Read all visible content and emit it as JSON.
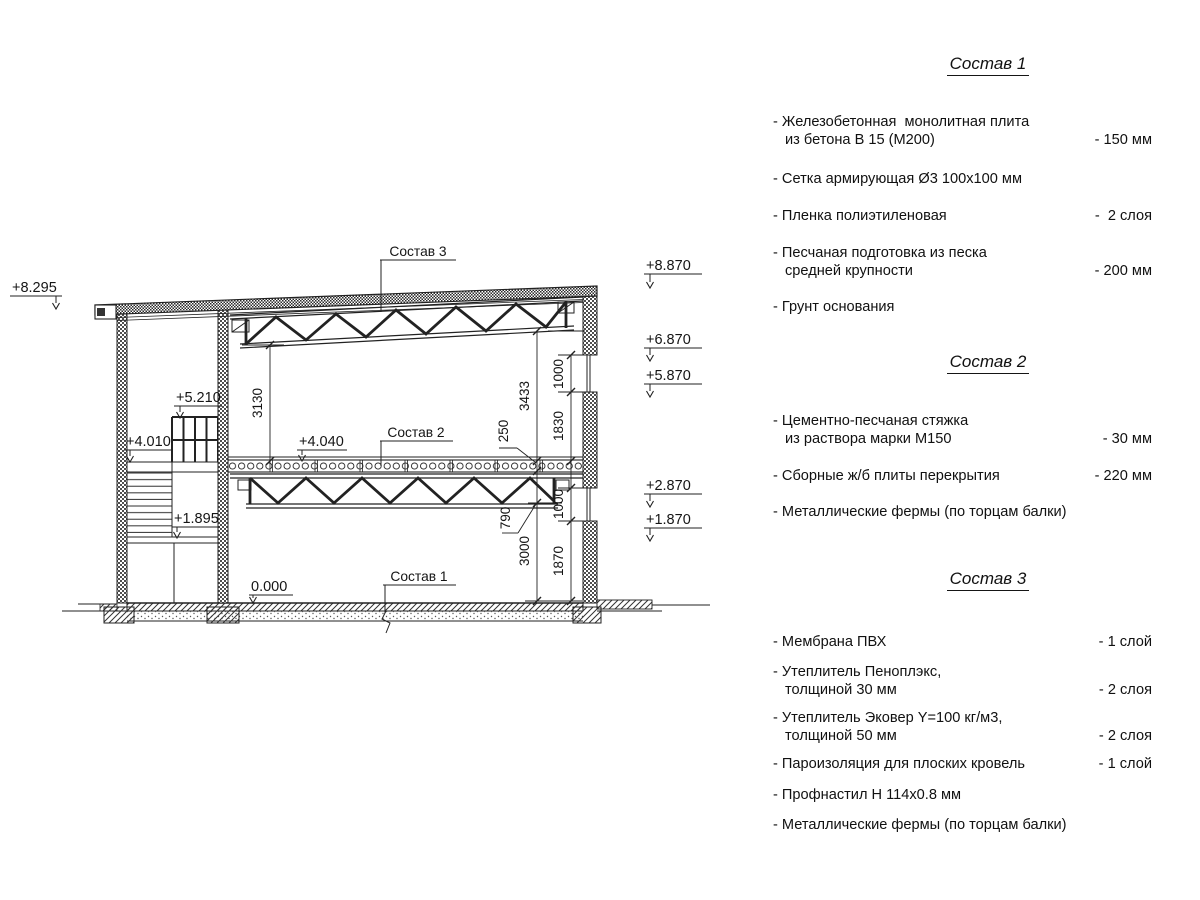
{
  "panel": {
    "sections": [
      {
        "title": "Состав 1",
        "items": [
          {
            "l1": "- Железобетонная  монолитная плита",
            "l2": "из бетона В 15 (М200)",
            "val": "- 150 мм"
          },
          {
            "l1": "- Сетка армирующая Ø3 100x100 мм",
            "l2": "",
            "val": ""
          },
          {
            "l1": "- Пленка полиэтиленовая",
            "l2": "",
            "val": "-  2 слоя"
          },
          {
            "l1": "- Песчаная подготовка из песка",
            "l2": "средней крупности",
            "val": "- 200 мм"
          },
          {
            "l1": "- Грунт основания",
            "l2": "",
            "val": ""
          }
        ]
      },
      {
        "title": "Состав 2",
        "items": [
          {
            "l1": "- Цементно-песчаная стяжка",
            "l2": "из раствора марки М150",
            "val": "- 30 мм"
          },
          {
            "l1": "- Сборные ж/б плиты перекрытия",
            "l2": "",
            "val": "- 220 мм"
          },
          {
            "l1": "- Металлические фермы (по торцам балки)",
            "l2": "",
            "val": ""
          }
        ]
      },
      {
        "title": "Состав 3",
        "items": [
          {
            "l1": "- Мембрана ПВХ",
            "l2": "",
            "val": "- 1 слой"
          },
          {
            "l1": "- Утеплитель Пеноплэкс,",
            "l2": "толщиной 30 мм",
            "val": "- 2 слоя"
          },
          {
            "l1": "- Утеплитель Эковер Y=100 кг/м3,",
            "l2": "толщиной 50 мм",
            "val": "- 2 слоя"
          },
          {
            "l1": "- Пароизоляция для плоских кровель",
            "l2": "",
            "val": "- 1 слой"
          },
          {
            "l1": "- Профнастил Н 114x0.8 мм",
            "l2": "",
            "val": ""
          },
          {
            "l1": "- Металлические фермы (по торцам балки)",
            "l2": "",
            "val": ""
          }
        ]
      }
    ]
  },
  "drawing": {
    "callouts": {
      "sostav1": "Состав 1",
      "sostav2": "Состав 2",
      "sostav3": "Состав 3"
    },
    "elevations": {
      "e8295": "+8.295",
      "e8870": "+8.870",
      "e6870": "+6.870",
      "e5870": "+5.870",
      "e2870": "+2.870",
      "e1870": "+1.870",
      "e5210": "+5.210",
      "e4010": "+4.010",
      "e4040": "+4.040",
      "e1895": "+1.895",
      "e0000": "0.000"
    },
    "dimensions": {
      "d3130": "3130",
      "d3433": "3433",
      "d250": "250",
      "d1000_top": "1000",
      "d1830": "1830",
      "d790": "790",
      "d3000": "3000",
      "d1000_bot": "1000",
      "d1870": "1870"
    }
  }
}
